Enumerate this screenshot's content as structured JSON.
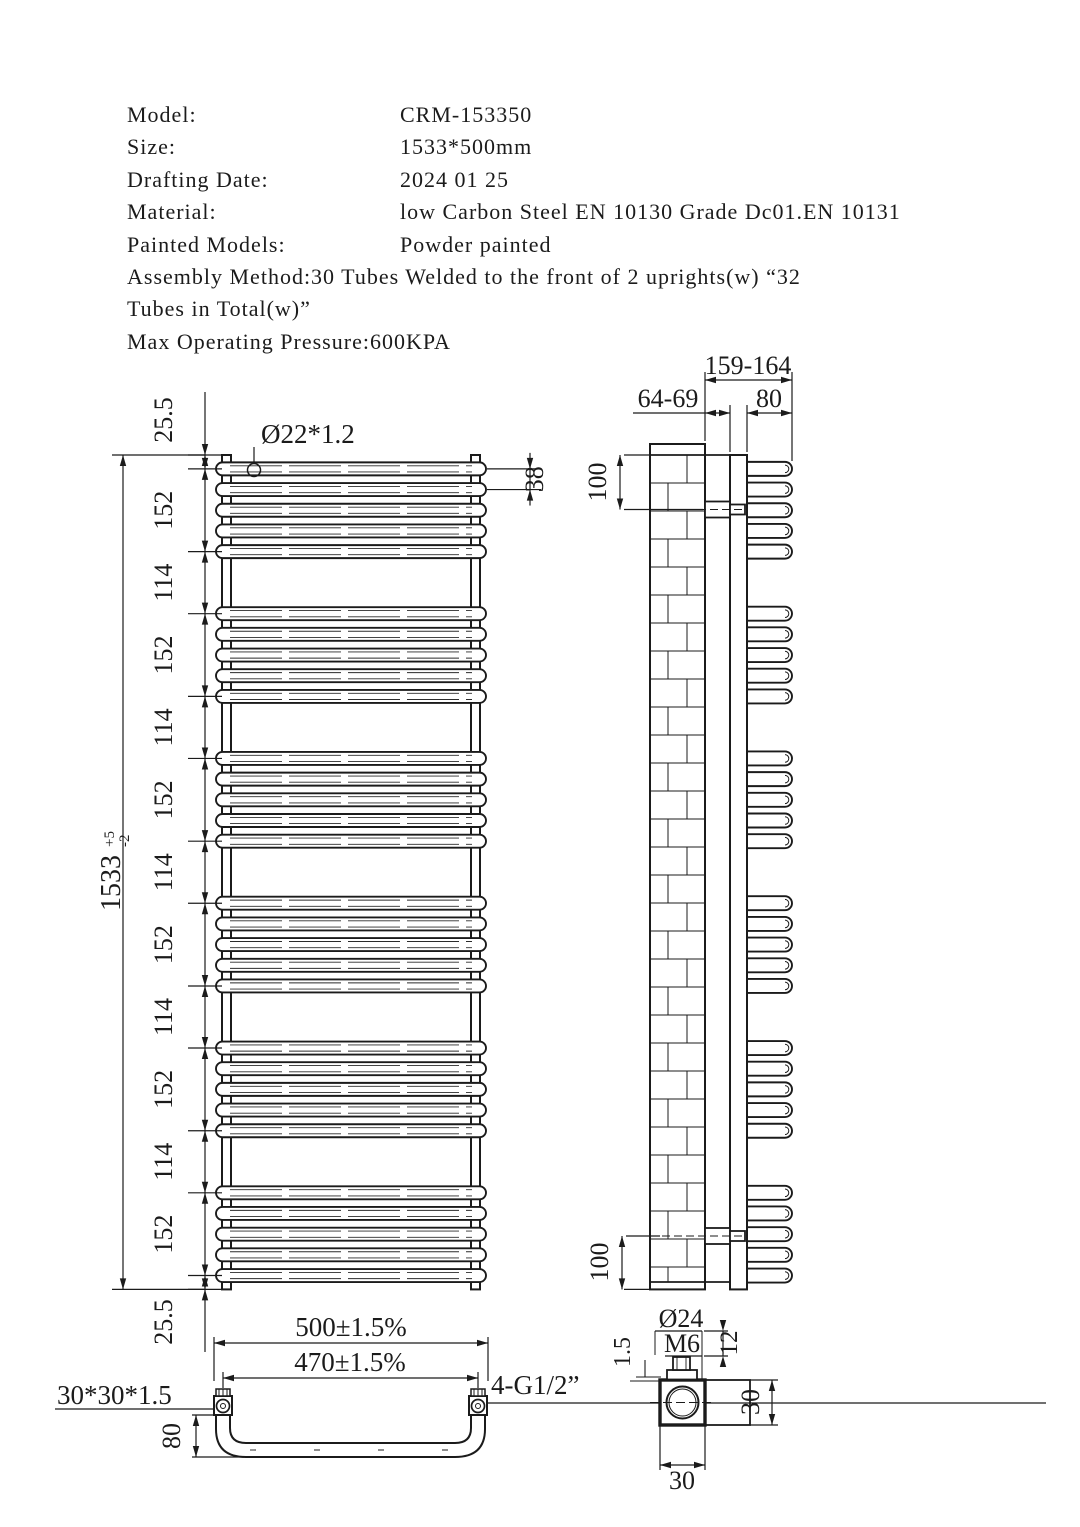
{
  "meta": {
    "title": "CRM-153350 towel radiator technical drawing",
    "bg": "#ffffff",
    "ink": "#1b1b1b"
  },
  "header": {
    "rows": [
      {
        "label": "Model:",
        "value": "CRM-153350"
      },
      {
        "label": "Size:",
        "value": "1533*500mm"
      },
      {
        "label": "Drafting Date:",
        "value": "2024 01 25"
      },
      {
        "label": "Material:",
        "value": "low Carbon Steel EN 10130 Grade Dc01.EN 10131"
      },
      {
        "label": "Painted Models:",
        "value": "Powder painted"
      }
    ],
    "assembly_line1": "Assembly Method:30 Tubes Welded to the front of 2 uprights(w) “32",
    "assembly_line2": "Tubes in Total(w)”",
    "pressure_line": "Max Operating Pressure:600KPA"
  },
  "front_view": {
    "tube_callout": "Ø22*1.2",
    "tube_pitch": "38",
    "overall_height": "1533",
    "tol_plus": "+5",
    "tol_minus": "-2",
    "dim_chain": [
      "25.5",
      "152",
      "114",
      "152",
      "114",
      "152",
      "114",
      "152",
      "114",
      "152",
      "114",
      "152",
      "25.5"
    ]
  },
  "side_view": {
    "overall_depth": "159-164",
    "wall_to_upright": "64-69",
    "tube_bow_depth": "80",
    "top_bracket_offset": "100",
    "bottom_bracket_offset": "100"
  },
  "bottom_view": {
    "overall_width": "500±1.5%",
    "port_centres": "470±1.5%",
    "upright_section": "30*30*1.5",
    "connections": "4-G1/2”",
    "bow_depth": "80"
  },
  "fitting_detail": {
    "hole_dia": "Ø24",
    "stud_thread": "M6",
    "wall_thickness": "1.5",
    "stud_length": "12",
    "section_height": "30",
    "section_width": "30"
  }
}
